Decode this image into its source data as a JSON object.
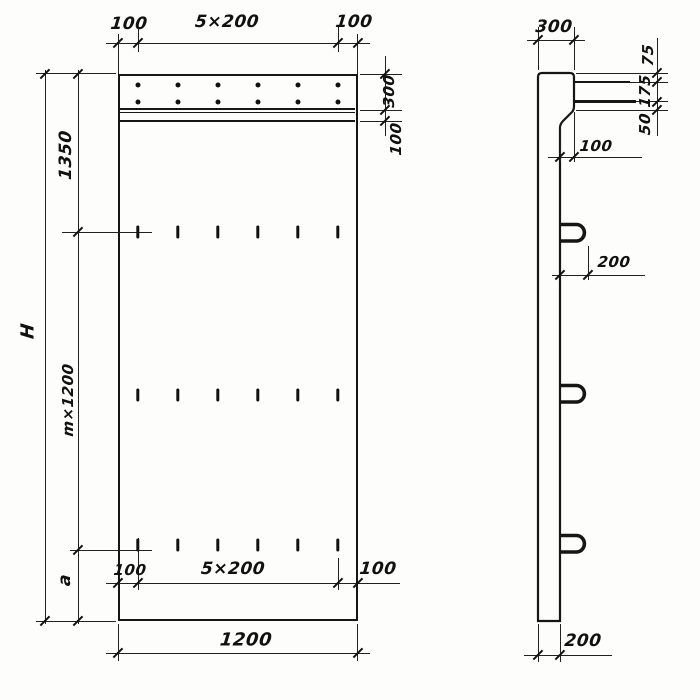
{
  "drawing": {
    "front_view": {
      "top_dims": {
        "left_margin": "100",
        "hole_spacing": "5×200",
        "right_margin": "100"
      },
      "right_dims": {
        "band_height": "300",
        "ledge_height": "100"
      },
      "left_dims": {
        "total_height": "H",
        "top_offset": "1350",
        "module_height": "m×1200",
        "bottom_offset": "a"
      },
      "bottom_inner_dims": {
        "left_margin": "100",
        "hole_spacing": "5×200",
        "right_margin": "100"
      },
      "bottom_dims": {
        "overall_width": "1200"
      }
    },
    "side_view": {
      "top_dims": {
        "top_thickness": "300"
      },
      "right_dims": {
        "top_to_bar": "75",
        "bar_spacing": "175",
        "bar_to_ledge": "50"
      },
      "ledge_dims": {
        "ledge_offset": "100"
      },
      "loop_dims": {
        "loop_projection": "200"
      },
      "bottom_dims": {
        "bottom_thickness": "200"
      }
    },
    "features": {
      "anchor_dot_columns": 6,
      "anchor_dot_rows": 2,
      "slot_columns": 6,
      "slot_rows": 3,
      "loop_count": 3
    }
  }
}
